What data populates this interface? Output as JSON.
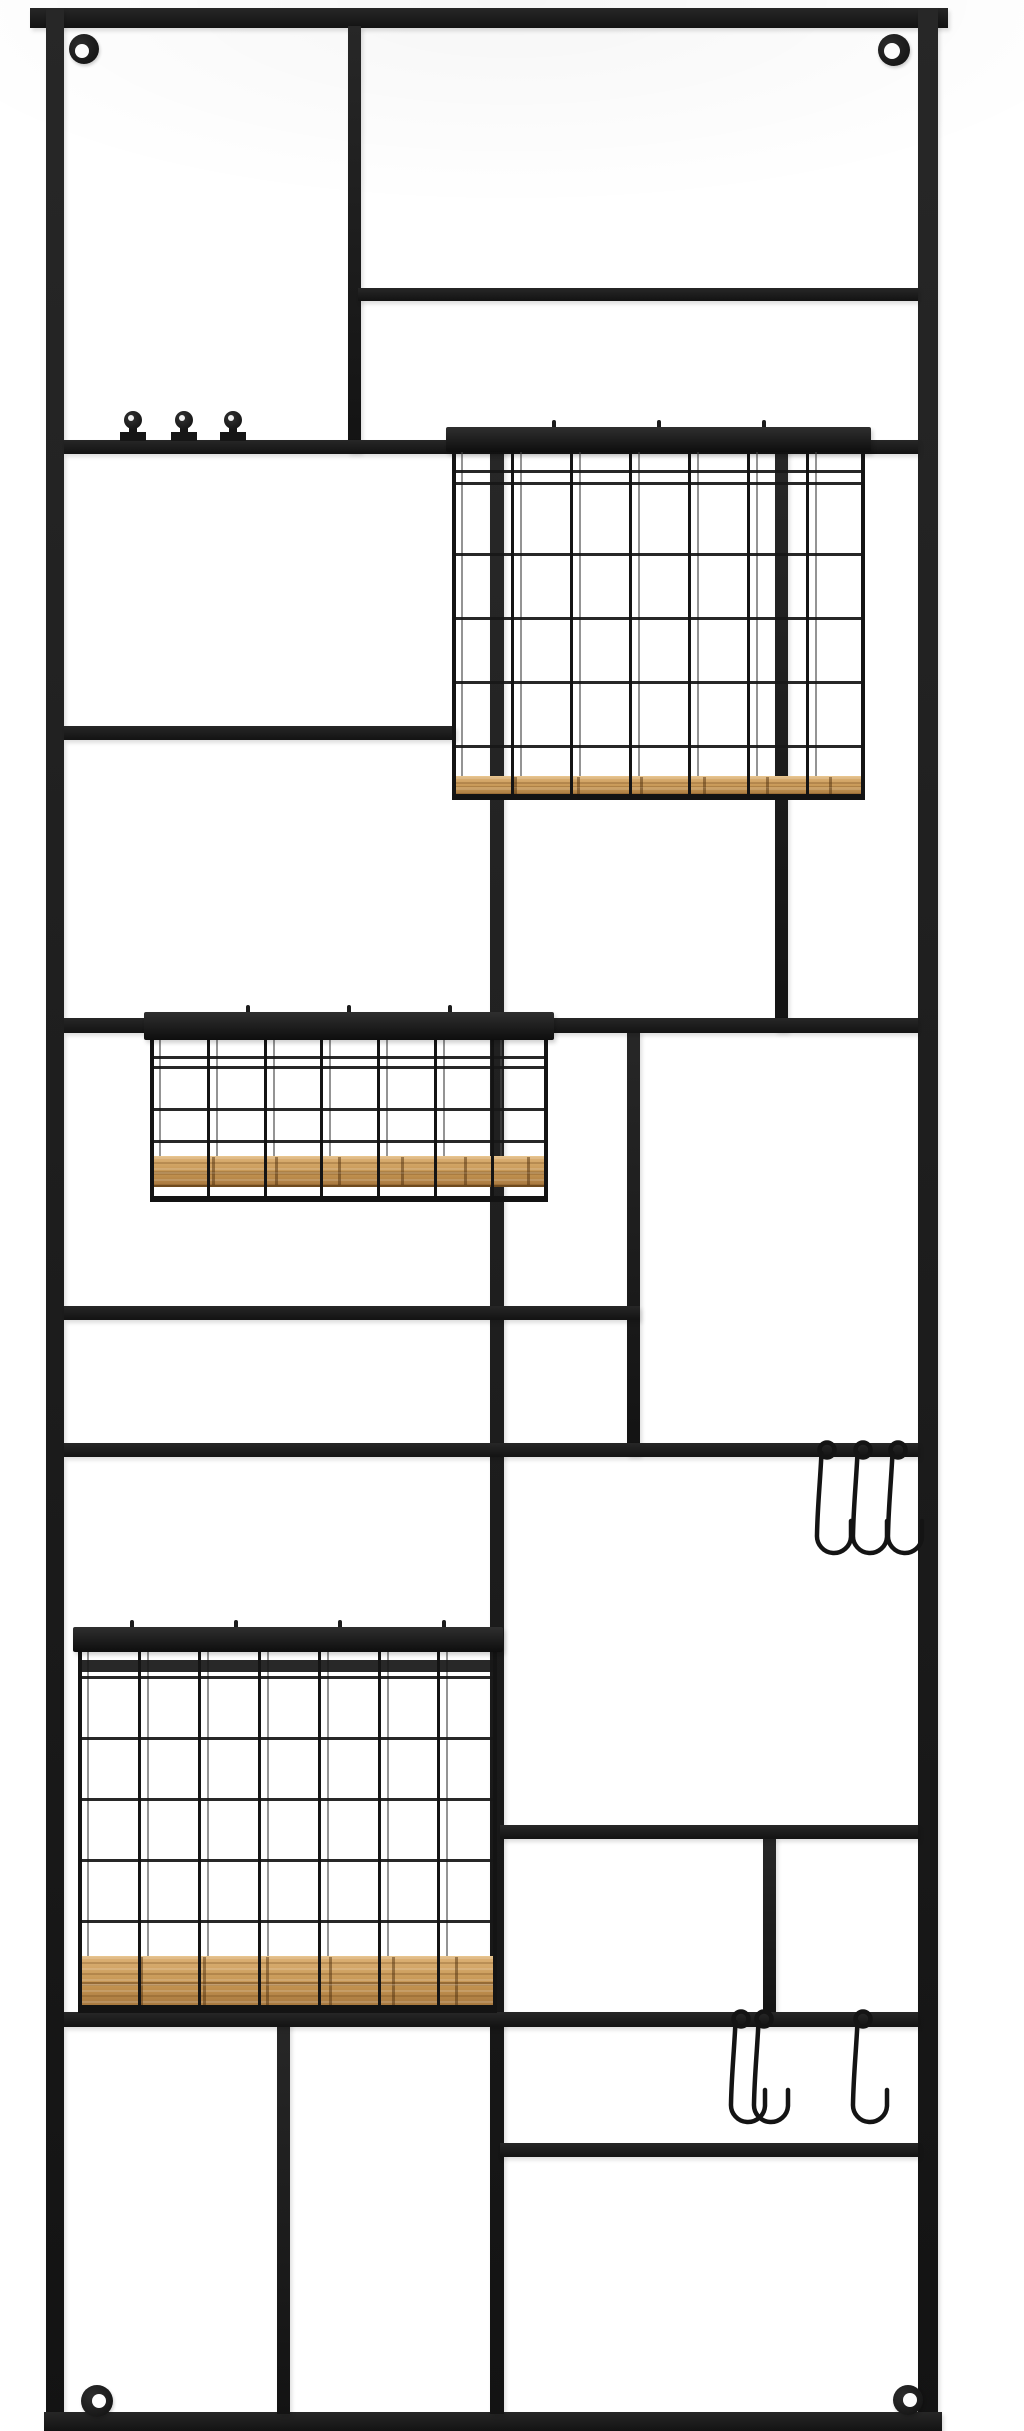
{
  "scene": {
    "description": "Black metal wall-mounted grid organizer rack with three wire baskets with wooden bases, three pegs, S-hooks and corner mounting tabs on a white background",
    "width": 1024,
    "height": 2431,
    "colors": {
      "background": "#ffffff",
      "metal": "#1b1b1b",
      "wire_back": "#4c4c4c",
      "wood_light": "#dcb175",
      "wood_mid": "#c39350",
      "wood_dark": "#a87940",
      "hook": "#141414"
    },
    "bars": [
      {
        "name": "frame-top-bar",
        "x": 30,
        "y": 8,
        "w": 918,
        "h": 20
      },
      {
        "name": "frame-left-bar",
        "x": 46,
        "y": 8,
        "w": 18,
        "h": 2423
      },
      {
        "name": "frame-right-bar",
        "x": 918,
        "y": 8,
        "w": 20,
        "h": 2423
      },
      {
        "name": "frame-bottom-bar",
        "x": 44,
        "y": 2412,
        "w": 898,
        "h": 19
      },
      {
        "name": "divider-vertical-1",
        "x": 348,
        "y": 26,
        "w": 13,
        "h": 426
      },
      {
        "name": "divider-vertical-2",
        "x": 775,
        "y": 448,
        "w": 13,
        "h": 583
      },
      {
        "name": "divider-vertical-3",
        "x": 490,
        "y": 448,
        "w": 14,
        "h": 1966
      },
      {
        "name": "divider-vertical-4",
        "x": 627,
        "y": 1030,
        "w": 13,
        "h": 425
      },
      {
        "name": "divider-vertical-5",
        "x": 277,
        "y": 2020,
        "w": 13,
        "h": 394
      },
      {
        "name": "divider-vertical-6",
        "x": 763,
        "y": 1836,
        "w": 13,
        "h": 182
      },
      {
        "name": "shelf-bar-top-right",
        "x": 358,
        "y": 288,
        "w": 560,
        "h": 13
      },
      {
        "name": "peg-bar",
        "x": 64,
        "y": 440,
        "w": 854,
        "h": 14
      },
      {
        "name": "shelf-bar-left-mid",
        "x": 64,
        "y": 726,
        "w": 392,
        "h": 14
      },
      {
        "name": "shelf-bar-full-1",
        "x": 64,
        "y": 1018,
        "w": 854,
        "h": 15
      },
      {
        "name": "shelf-bar-left-2",
        "x": 64,
        "y": 1306,
        "w": 576,
        "h": 14
      },
      {
        "name": "hook-bar-middle",
        "x": 64,
        "y": 1443,
        "w": 854,
        "h": 14
      },
      {
        "name": "shelf-bar-right-low",
        "x": 500,
        "y": 1825,
        "w": 418,
        "h": 14
      },
      {
        "name": "hook-bar-bottom",
        "x": 64,
        "y": 2012,
        "w": 854,
        "h": 15
      },
      {
        "name": "shelf-bar-bottom-right",
        "x": 500,
        "y": 2143,
        "w": 418,
        "h": 14
      }
    ],
    "tabs": [
      {
        "name": "mounting-tab-top-left",
        "cx": 84,
        "cy": 49,
        "r": 15,
        "hr": 7,
        "dx": -2,
        "dy": 2
      },
      {
        "name": "mounting-tab-top-right",
        "cx": 894,
        "cy": 50,
        "r": 16,
        "hr": 8,
        "dx": -2,
        "dy": 1
      },
      {
        "name": "mounting-tab-bottom-left",
        "cx": 97,
        "cy": 2401,
        "r": 16,
        "hr": 7,
        "dx": 2,
        "dy": 0
      },
      {
        "name": "mounting-tab-bottom-right",
        "cx": 908,
        "cy": 2400,
        "r": 15,
        "hr": 7,
        "dx": 2,
        "dy": 0
      }
    ],
    "pegs": {
      "bar_top": 440,
      "items": [
        133,
        184,
        233
      ]
    },
    "baskets": [
      {
        "name": "wire-basket-top",
        "x": 452,
        "y": 427,
        "w": 413,
        "h": 373,
        "rail": {
          "dx": -6,
          "w": 425,
          "h": 25
        },
        "cage_top": 25,
        "cols": [
          0,
          59,
          118,
          177,
          236,
          295,
          354,
          410
        ],
        "back_offset": 9,
        "rows": [
          {
            "y": 43,
            "h": 3
          },
          {
            "y": 55,
            "h": 3
          },
          {
            "y": 126,
            "h": 3
          },
          {
            "y": 190,
            "h": 3
          },
          {
            "y": 254,
            "h": 3
          },
          {
            "y": 318,
            "h": 3
          }
        ],
        "wood": {
          "y": 349,
          "h": 18
        },
        "rim": {
          "y": 367,
          "h": 6
        },
        "ticks": [
          100,
          205,
          310
        ]
      },
      {
        "name": "wire-basket-middle",
        "x": 150,
        "y": 1012,
        "w": 398,
        "h": 190,
        "rail": {
          "dx": -6,
          "w": 410,
          "h": 28
        },
        "cage_top": 28,
        "cols": [
          0,
          57,
          114,
          170,
          227,
          284,
          341,
          395
        ],
        "back_offset": 9,
        "rows": [
          {
            "y": 44,
            "h": 3
          },
          {
            "y": 54,
            "h": 3
          },
          {
            "y": 96,
            "h": 3
          },
          {
            "y": 128,
            "h": 3
          }
        ],
        "wood": {
          "y": 144,
          "h": 28
        },
        "rim": {
          "y": 184,
          "h": 6
        },
        "ticks": [
          96,
          197,
          298
        ]
      },
      {
        "name": "wire-basket-bottom",
        "x": 78,
        "y": 1627,
        "w": 419,
        "h": 386,
        "rail": {
          "dx": -5,
          "w": 430,
          "h": 25
        },
        "cage_top": 25,
        "cols": [
          0,
          60,
          120,
          180,
          240,
          300,
          359,
          416
        ],
        "back_offset": 9,
        "rows": [
          {
            "y": 33,
            "h": 12
          },
          {
            "y": 49,
            "h": 3
          },
          {
            "y": 110,
            "h": 3
          },
          {
            "y": 171,
            "h": 3
          },
          {
            "y": 232,
            "h": 3
          },
          {
            "y": 293,
            "h": 3
          }
        ],
        "wood": {
          "y": 329,
          "h": 48
        },
        "rim": {
          "y": 378,
          "h": 8
        },
        "ticks": [
          52,
          156,
          260,
          364
        ]
      }
    ],
    "hooks": {
      "loop": {
        "cx": 22,
        "cy": 11,
        "r": 7.5
      },
      "path": "M 16.5 14 C 15 45 12.5 68 12 96 a 17 17 0 0 0 34 2 l 0 -16",
      "stroke_width": 4.5,
      "items": [
        {
          "name": "s-hook-middle-1",
          "x": 805,
          "y": 1439
        },
        {
          "name": "s-hook-middle-2",
          "x": 841,
          "y": 1439
        },
        {
          "name": "s-hook-middle-3",
          "x": 876,
          "y": 1439
        },
        {
          "name": "s-hook-bottom-1",
          "x": 719,
          "y": 2008
        },
        {
          "name": "s-hook-bottom-2",
          "x": 742,
          "y": 2008
        },
        {
          "name": "s-hook-bottom-3",
          "x": 841,
          "y": 2008
        }
      ]
    }
  }
}
